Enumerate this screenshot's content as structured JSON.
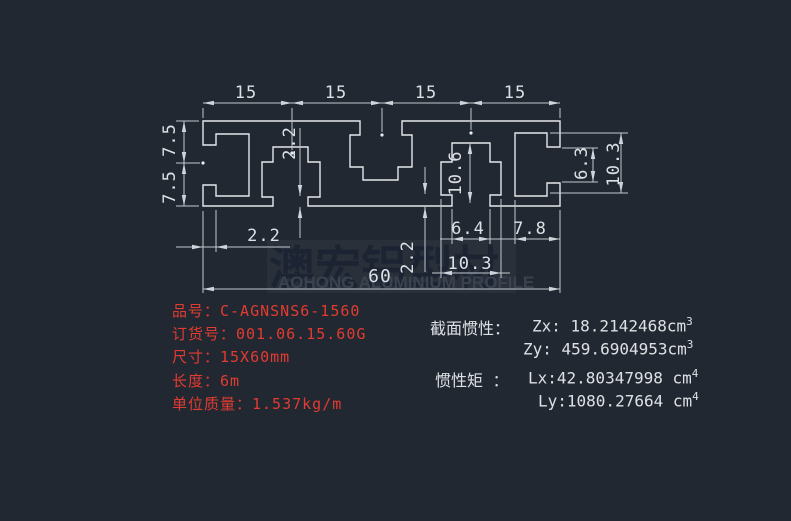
{
  "colors": {
    "background": "#222831",
    "line": "#c3c9d0",
    "dim_text": "#dde1e5",
    "product_red": "#e23b31",
    "watermark_panel": "#2a303a",
    "watermark_cn": "#1c2433",
    "watermark_en": "#3a4250"
  },
  "dims": {
    "top": [
      "15",
      "15",
      "15",
      "15"
    ],
    "left": [
      "7.5",
      "7.5"
    ],
    "lip_depth": "2.2",
    "wall_1": "2.2",
    "wall_2": "2.2",
    "slot_height": "10.6",
    "mouth_width": "6.4",
    "end_width": "7.8",
    "cavity_width": "10.3",
    "right_mouth": "6.3",
    "right_cavity": "10.3",
    "overall_width": "60"
  },
  "watermark": {
    "cn": "澳宏铝型材",
    "en": "AOHONG ALUMINIUM PROFILE"
  },
  "product": {
    "lines": [
      "品号：C-AGNSNS6-1560",
      "订货号：001.06.15.60G",
      "尺寸：15X60mm",
      "长度：6m",
      "单位质量：1.537kg/m"
    ]
  },
  "props": {
    "heading_inertia": "截面惯性：",
    "zx": "Zx: 18.2142468cm",
    "zx_exp": "3",
    "zy": "Zy: 459.6904953cm",
    "zy_exp": "3",
    "heading_moment": "惯性矩 ：",
    "lx": "Lx:42.80347998 cm",
    "lx_exp": "4",
    "ly": "Ly:1080.27664 cm",
    "ly_exp": "4"
  }
}
